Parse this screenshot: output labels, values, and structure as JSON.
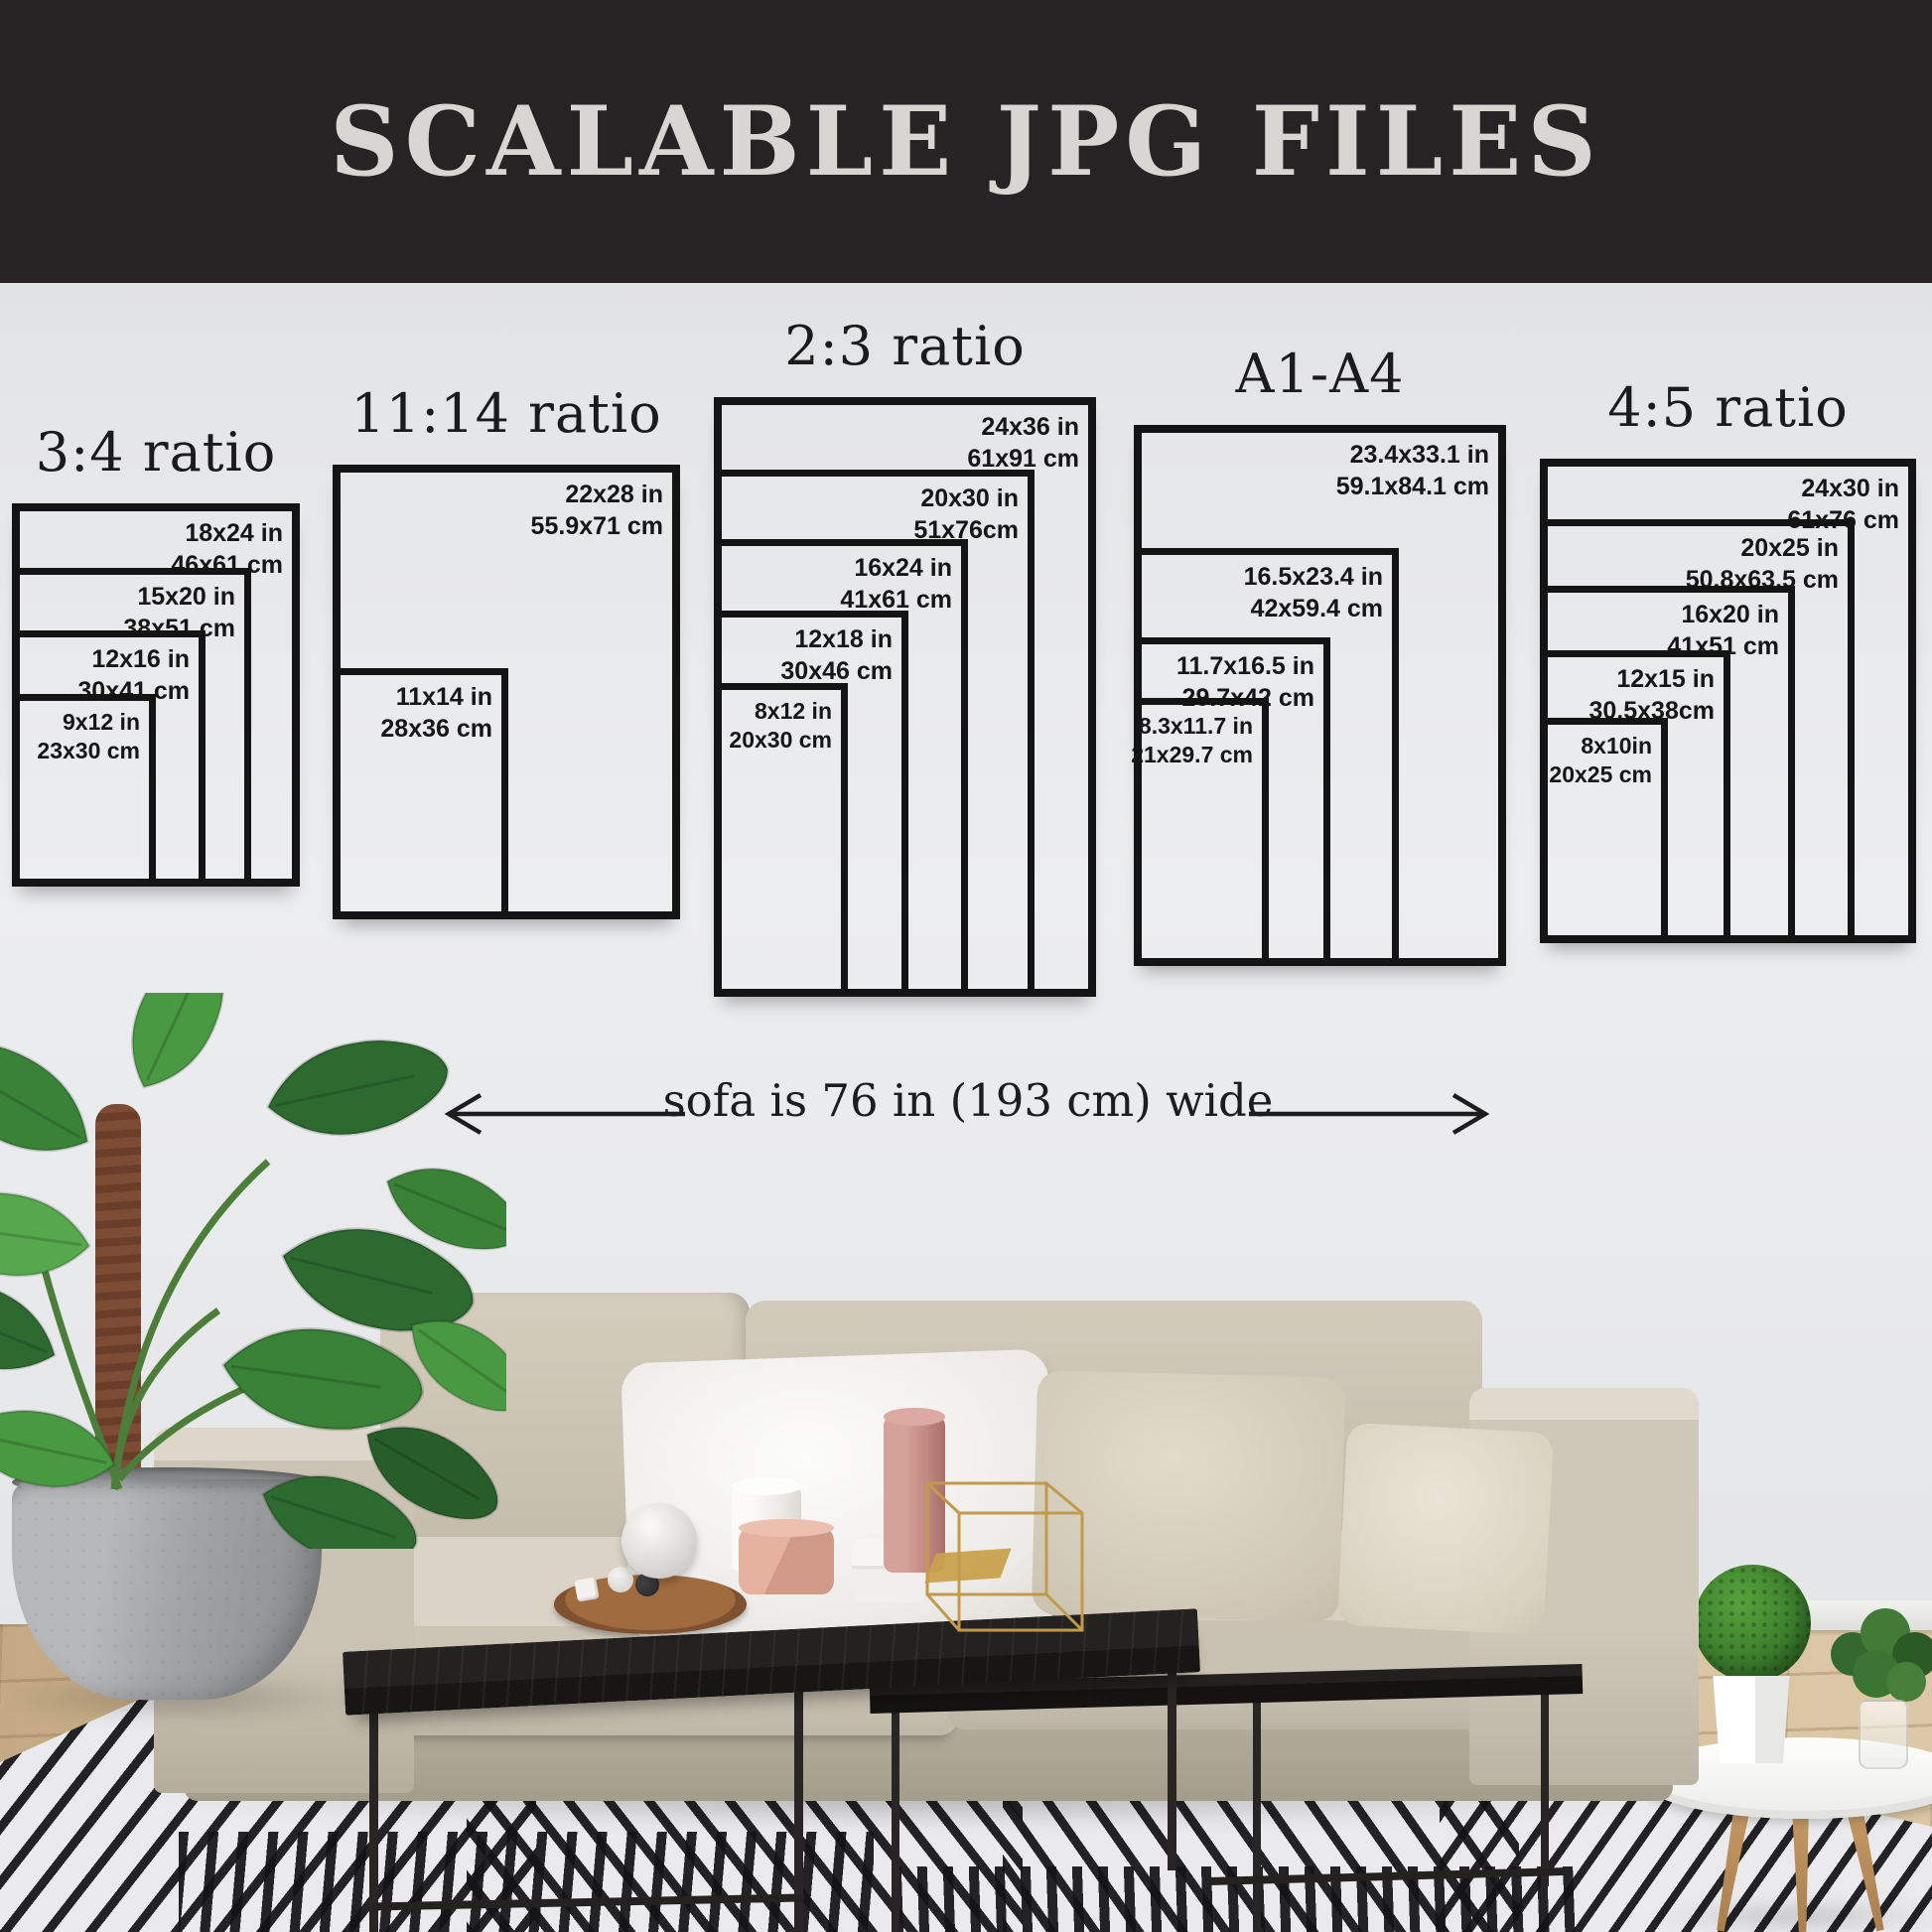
{
  "banner": {
    "title": "SCALABLE JPG FILES"
  },
  "size_groups": [
    {
      "title": "3:4 ratio",
      "sizes": [
        {
          "inches": "18x24 in",
          "cm": "46x61 cm"
        },
        {
          "inches": "15x20 in",
          "cm": "38x51 cm"
        },
        {
          "inches": "12x16 in",
          "cm": "30x41 cm"
        },
        {
          "inches": "9x12 in",
          "cm": "23x30 cm"
        }
      ]
    },
    {
      "title": "11:14 ratio",
      "sizes": [
        {
          "inches": "22x28 in",
          "cm": "55.9x71 cm"
        },
        {
          "inches": "11x14 in",
          "cm": "28x36 cm"
        }
      ]
    },
    {
      "title": "2:3 ratio",
      "sizes": [
        {
          "inches": "24x36 in",
          "cm": "61x91 cm"
        },
        {
          "inches": "20x30 in",
          "cm": "51x76cm"
        },
        {
          "inches": "16x24 in",
          "cm": "41x61 cm"
        },
        {
          "inches": "12x18 in",
          "cm": "30x46 cm"
        },
        {
          "inches": "8x12 in",
          "cm": "20x30 cm"
        }
      ]
    },
    {
      "title": "A1-A4",
      "sizes": [
        {
          "inches": "23.4x33.1 in",
          "cm": "59.1x84.1 cm"
        },
        {
          "inches": "16.5x23.4 in",
          "cm": "42x59.4 cm"
        },
        {
          "inches": "11.7x16.5 in",
          "cm": "29.7x42 cm"
        },
        {
          "inches": "8.3x11.7 in",
          "cm": "21x29.7 cm"
        }
      ]
    },
    {
      "title": "4:5 ratio",
      "sizes": [
        {
          "inches": "24x30 in",
          "cm": "61x76 cm"
        },
        {
          "inches": "20x25 in",
          "cm": "50.8x63.5 cm"
        },
        {
          "inches": "16x20 in",
          "cm": "41x51 cm"
        },
        {
          "inches": "12x15 in",
          "cm": "30.5x38cm"
        },
        {
          "inches": "8x10in",
          "cm": "20x25 cm"
        }
      ]
    }
  ],
  "sofa_note": {
    "text": "sofa is 76 in (193 cm) wide"
  },
  "colors": {
    "banner_bg": "#272324",
    "banner_text": "#d8d6d3",
    "diagram_line": "#141414",
    "label_text": "#161616",
    "wall": "#e7e8ea",
    "sofa_fabric": "#cdc5b5",
    "rug_stripe": "#141417",
    "floor_wood": "#d6c09c"
  }
}
